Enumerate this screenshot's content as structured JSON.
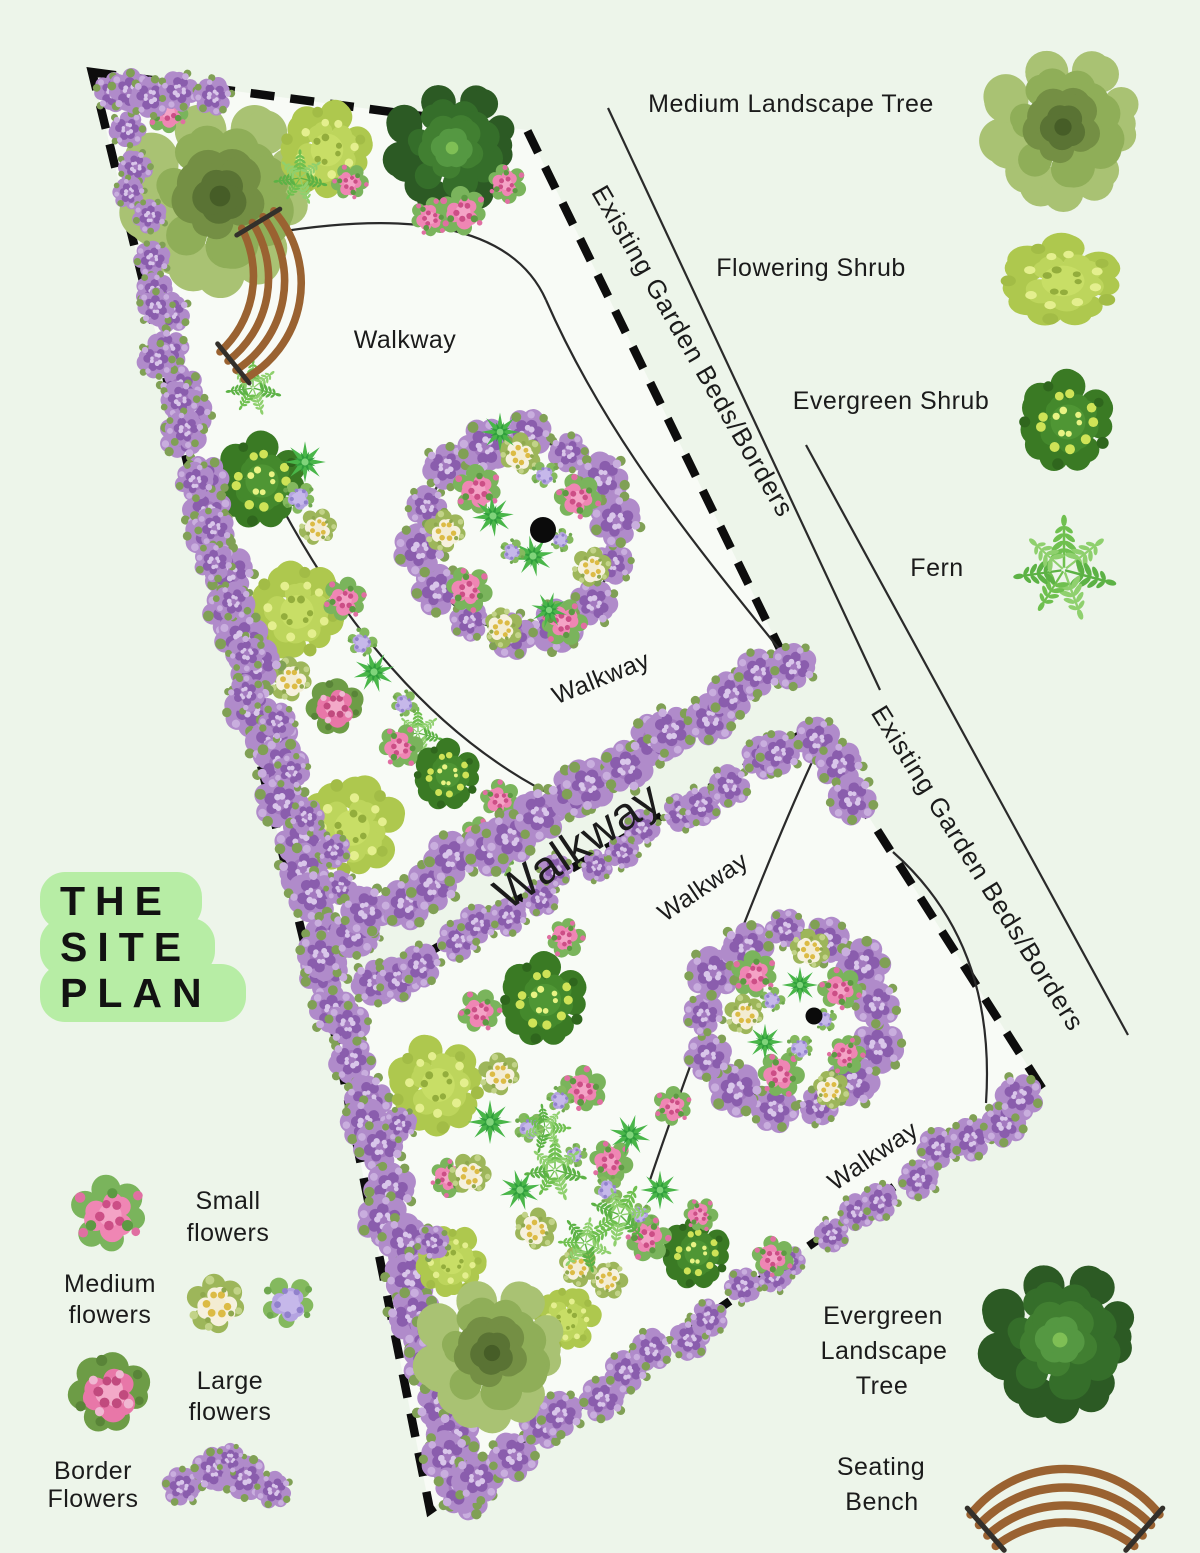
{
  "title": {
    "line1": "THE",
    "line2": "SITE",
    "line3": "PLAN"
  },
  "plan": {
    "walkway_label": "Walkway",
    "existing_beds_label": "Existing Garden Beds/Borders"
  },
  "legend_right": {
    "medium_tree": "Medium Landscape Tree",
    "flowering_shrub": "Flowering Shrub",
    "evergreen_shrub": "Evergreen Shrub",
    "fern": "Fern",
    "evergreen_tree_lines": [
      "Evergreen",
      "Landscape",
      "Tree"
    ],
    "seating_bench_lines": [
      "Seating",
      "Bench"
    ]
  },
  "legend_flowers": {
    "small": [
      "Small",
      "flowers"
    ],
    "medium": [
      "Medium",
      "flowers"
    ],
    "large": [
      "Large",
      "flowers"
    ],
    "border": [
      "Border",
      "Flowers"
    ]
  },
  "icons": {
    "medium-landscape-tree-icon": "light green fringed tree canopy",
    "flowering-shrub-icon": "yellow-green oval shrub",
    "evergreen-shrub-icon": "dark green round shrub with yellow specks",
    "fern-icon": "green fern fronds",
    "evergreen-landscape-tree-icon": "dark green dense tree canopy",
    "seating-bench-icon": "curved brown slatted bench",
    "small-flowers-icon": "pink flower cluster",
    "medium-flowers-icon": "white-yellow and purple flower clusters",
    "large-flowers-icon": "pink and green large flower cluster",
    "border-flowers-icon": "chain of purple flower clusters",
    "circular-flower-bed": "ring of purple border flowers with mixed flowers and center point",
    "walkway-band": "diagonal walkway between dashed plot borders"
  },
  "colors": {
    "background": "#edf5ea",
    "plot_fill": "#f8fbf6",
    "boundary_dash": "#0d0d0d",
    "thin_line": "#2a2a2a",
    "title_badge": "#b7eda5",
    "text": "#1b1b1b",
    "border_flower_purple": "#b08bca",
    "pink_flower": "#ef86b4",
    "white_flower": "#f6f1de",
    "lavender_flower": "#b5a4e1",
    "medium_tree_green": "#8fae58",
    "evergreen_tree_green": "#356e2a",
    "flowering_shrub_green": "#bdd55c",
    "evergreen_shrub_green": "#3a7a24",
    "fern_green": "#6fc04f",
    "bench_brown": "#9a6231"
  }
}
